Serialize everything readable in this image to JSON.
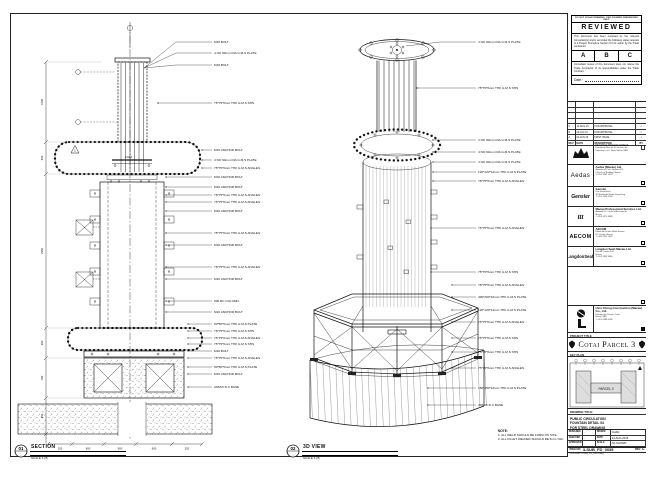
{
  "sheet": {
    "section_view": {
      "bubble_num": "01",
      "title": "SECTION",
      "scale": "SCALE 1:25",
      "cloud_tag": "2-M-2",
      "rev_triangle": "1",
      "dims_left": [
        "1200",
        "450",
        "2350",
        "300",
        "700",
        "450"
      ],
      "dims_bottom": [
        "250",
        "600",
        "900",
        "600",
        "250"
      ],
      "callouts": [
        {
          "y": 28,
          "t": "M16 BOLT"
        },
        {
          "y": 39,
          "t": "4 NO 90mm DIA G.M.S PLATE"
        },
        {
          "y": 51,
          "t": "M16 BOLT"
        },
        {
          "y": 89,
          "t": "75*75*6mm THK G.M.S SHS"
        },
        {
          "y": 136,
          "t": "M16 ANCHOR BOLT"
        },
        {
          "y": 146,
          "t": "4 NO 90mm DIA G.M.S PLATE"
        },
        {
          "y": 154,
          "t": "75*75*6mm THK G.M.S ANGLES"
        },
        {
          "y": 163,
          "t": "M16 ANCHOR BOLT"
        },
        {
          "y": 173,
          "t": "M16 ANCHOR BOLT"
        },
        {
          "y": 181,
          "t": "75*75*6mm THK G.M.S ANGLES"
        },
        {
          "y": 188,
          "t": "75*75*6mm THK G.M.S ANGLES"
        },
        {
          "y": 197,
          "t": "M16 ANCHOR BOLT"
        },
        {
          "y": 219,
          "t": "75*75*6mm THK G.M.S ANGLES"
        },
        {
          "y": 231,
          "t": "M16 ANCHOR BOLT"
        },
        {
          "y": 253,
          "t": "75*75*6mm THK G.M.S ANGLES"
        },
        {
          "y": 265,
          "t": "M16 ANCHOR BOLT"
        },
        {
          "y": 287,
          "t": "600 RC COLUMN"
        },
        {
          "y": 298,
          "t": "M16 ANCHOR BOLT"
        },
        {
          "y": 310,
          "t": "50*50*5mm THK G.M.S PLATE"
        },
        {
          "y": 317,
          "t": "75*75*6mm THK G.M.S SHS"
        },
        {
          "y": 324,
          "t": "75*75*6mm THK G.M.S ANGLES"
        },
        {
          "y": 330,
          "t": "75*75*6mm THK G.M.S SHS"
        },
        {
          "y": 337,
          "t": "M16 BOLT"
        },
        {
          "y": 344,
          "t": "75*75*6mm THK G.M.S ANGLES"
        },
        {
          "y": 353,
          "t": "50*50*5mm THK G.M.S PLATE"
        },
        {
          "y": 360,
          "t": "M16 ANCHOR BOLT"
        },
        {
          "y": 373,
          "t": "ADMIX R.C BASE"
        }
      ]
    },
    "iso_view": {
      "bubble_num": "02",
      "title": "3D VIEW",
      "scale": "SCALE 1:25",
      "callouts": [
        {
          "y": 28,
          "t": "4 NO 90mm DIA G.M.S PLATE"
        },
        {
          "y": 74,
          "t": "75*75*6mm THK G.M.S SHS"
        },
        {
          "y": 126,
          "t": "4 NO 90mm DIA G.M.S PLATE"
        },
        {
          "y": 138,
          "t": "4 NO 90mm DIA G.M.S PLATE"
        },
        {
          "y": 148,
          "t": "4 NO 90mm DIA G.M.S PLATE"
        },
        {
          "y": 158,
          "t": "120*120*12mm THK G.M.S PLATE"
        },
        {
          "y": 167,
          "t": "75*75*6mm THK G.M.S ANGLES"
        },
        {
          "y": 214,
          "t": "75*75*6mm THK G.M.S ANGLES"
        },
        {
          "y": 258,
          "t": "75*75*6mm THK G.M.S SHS"
        },
        {
          "y": 271,
          "t": "75*75*6mm THK G.M.S ANGLES"
        },
        {
          "y": 283,
          "t": "400*200*16mm THK G.M.S PLATE"
        },
        {
          "y": 296,
          "t": "120*120*12mm THK G.M.S PLATE"
        },
        {
          "y": 308,
          "t": "75*75*6mm THK G.M.S ANGLES"
        },
        {
          "y": 324,
          "t": "75*75*6mm THK G.M.S SHS"
        },
        {
          "y": 338,
          "t": "75*75*6mm THK G.M.S SHS"
        },
        {
          "y": 354,
          "t": "75*75*6mm THK G.M.S ANGLES"
        },
        {
          "y": 374,
          "t": "150*150*16mm THK G.M.S PLATE"
        },
        {
          "y": 391,
          "t": "ADMIX R.C BASE"
        }
      ]
    },
    "notes": {
      "title": "NOTE:",
      "lines": [
        "1. ALL WELD SHOULD BE FORM ON SITE.",
        "2. ALL FILLET WELDED SHOULD BE 6mm THK."
      ]
    }
  },
  "titleblock": {
    "stamp": {
      "header": "DO NOT SCALE DRAWING. USE FIGURED DIMENSIONS ONLY.",
      "reviewed": "REVIEWED",
      "para1": "This document has been reviewed by the relevant Consultant(s) and is accorded the following status relevant to a Project Procedure Section 5.4 for action by the Trade Contractor.",
      "options": [
        "A",
        "B",
        "C"
      ],
      "para2": "Consultant review of this document does not relieve the Trade Contractor of its responsibilities under the Trade Contract.",
      "date_label": "Date :"
    },
    "revisions": {
      "header": [
        "REV",
        "DATE",
        "DESCRIPTION",
        "BY"
      ],
      "rows": [
        [
          "C",
          "14-AUG-15",
          "FOR APPROVAL",
          "✓"
        ],
        [
          "B",
          "20-JUL-15",
          "FOR APPROVAL",
          "✓"
        ],
        [
          "A",
          "02-JUN-15",
          "FIRST ISSUE",
          "✓"
        ]
      ]
    },
    "client": {
      "name": "Venetian Orient Limited",
      "addr": [
        "Estrada da Baía de N. Senhora da",
        "Esperança, s/n, Taipa, Macau SAR"
      ]
    },
    "consultants": [
      {
        "logo": "Aedas",
        "name": "Aedas (Macau) Ltd.",
        "addr": [
          "Avenida da Praia Grande 409,",
          "China Law Building, Macau",
          "T +853 2833 1333"
        ]
      },
      {
        "logo": "Gensler",
        "name": "Gensler",
        "addr": [
          "One Island East,",
          "18 Westlands Road, Hong Kong",
          "T +852 2599 8788"
        ]
      },
      {
        "logo": "ttt",
        "name": "Macau Professional Services Ltd.",
        "addr": [
          "Alameda Dr. Carlos d'Assumpção,",
          "Macau",
          "T +853 2875 3088"
        ]
      },
      {
        "logo": "AECOM",
        "name": "AECOM",
        "addr": [
          "8 Avenida Doutor Mário Soares,",
          "FIT Centre, Macau",
          "T +853 2872 2633"
        ]
      },
      {
        "logo": "LangdonSeah",
        "name": "Langdon Seah Macau Ltd.",
        "addr": [
          "Rua do Campo 202,",
          "Macau",
          "T +853 2833 3088"
        ]
      }
    ],
    "contractor": {
      "name": "Hsin Chong Construction (Macau) Co., Ltd.",
      "addr": [
        "Estrada dos Parses, Cotai,",
        "Macau SAR",
        "T +853 2888 6188"
      ]
    },
    "project": {
      "label": "PROJECT TITLE",
      "name": "Cotai Parcel 3"
    },
    "keyplan": {
      "label": "KEY PLAN",
      "note": "PARCEL 3"
    },
    "drawing": {
      "label": "DRAWING TITLE:",
      "lines": [
        "PUBLIC CIRCULATION",
        "FOUNTAIN DETAIL 04",
        "FOR STEEL DRAWING"
      ]
    },
    "info": {
      "designed_label": "DESIGNED",
      "designed": "-",
      "drawn_label": "DRAWN",
      "drawn": "CHAD",
      "checked_label": "CHECKED",
      "checked": "-",
      "date_label": "DATE",
      "date": "14-AUG-2015",
      "approved_label": "APPROVED",
      "approved": "-",
      "scale_label": "SCALE",
      "scale": "AS SHOWN",
      "dwg_label": "DWG NO:",
      "dwg_no": "3-SUB_FD_0035",
      "rev_label": "REV:",
      "rev": "C",
      "cad_label": "CAD FILE:",
      "cad_file": "3-SUB_FD_0035.dwg"
    }
  }
}
